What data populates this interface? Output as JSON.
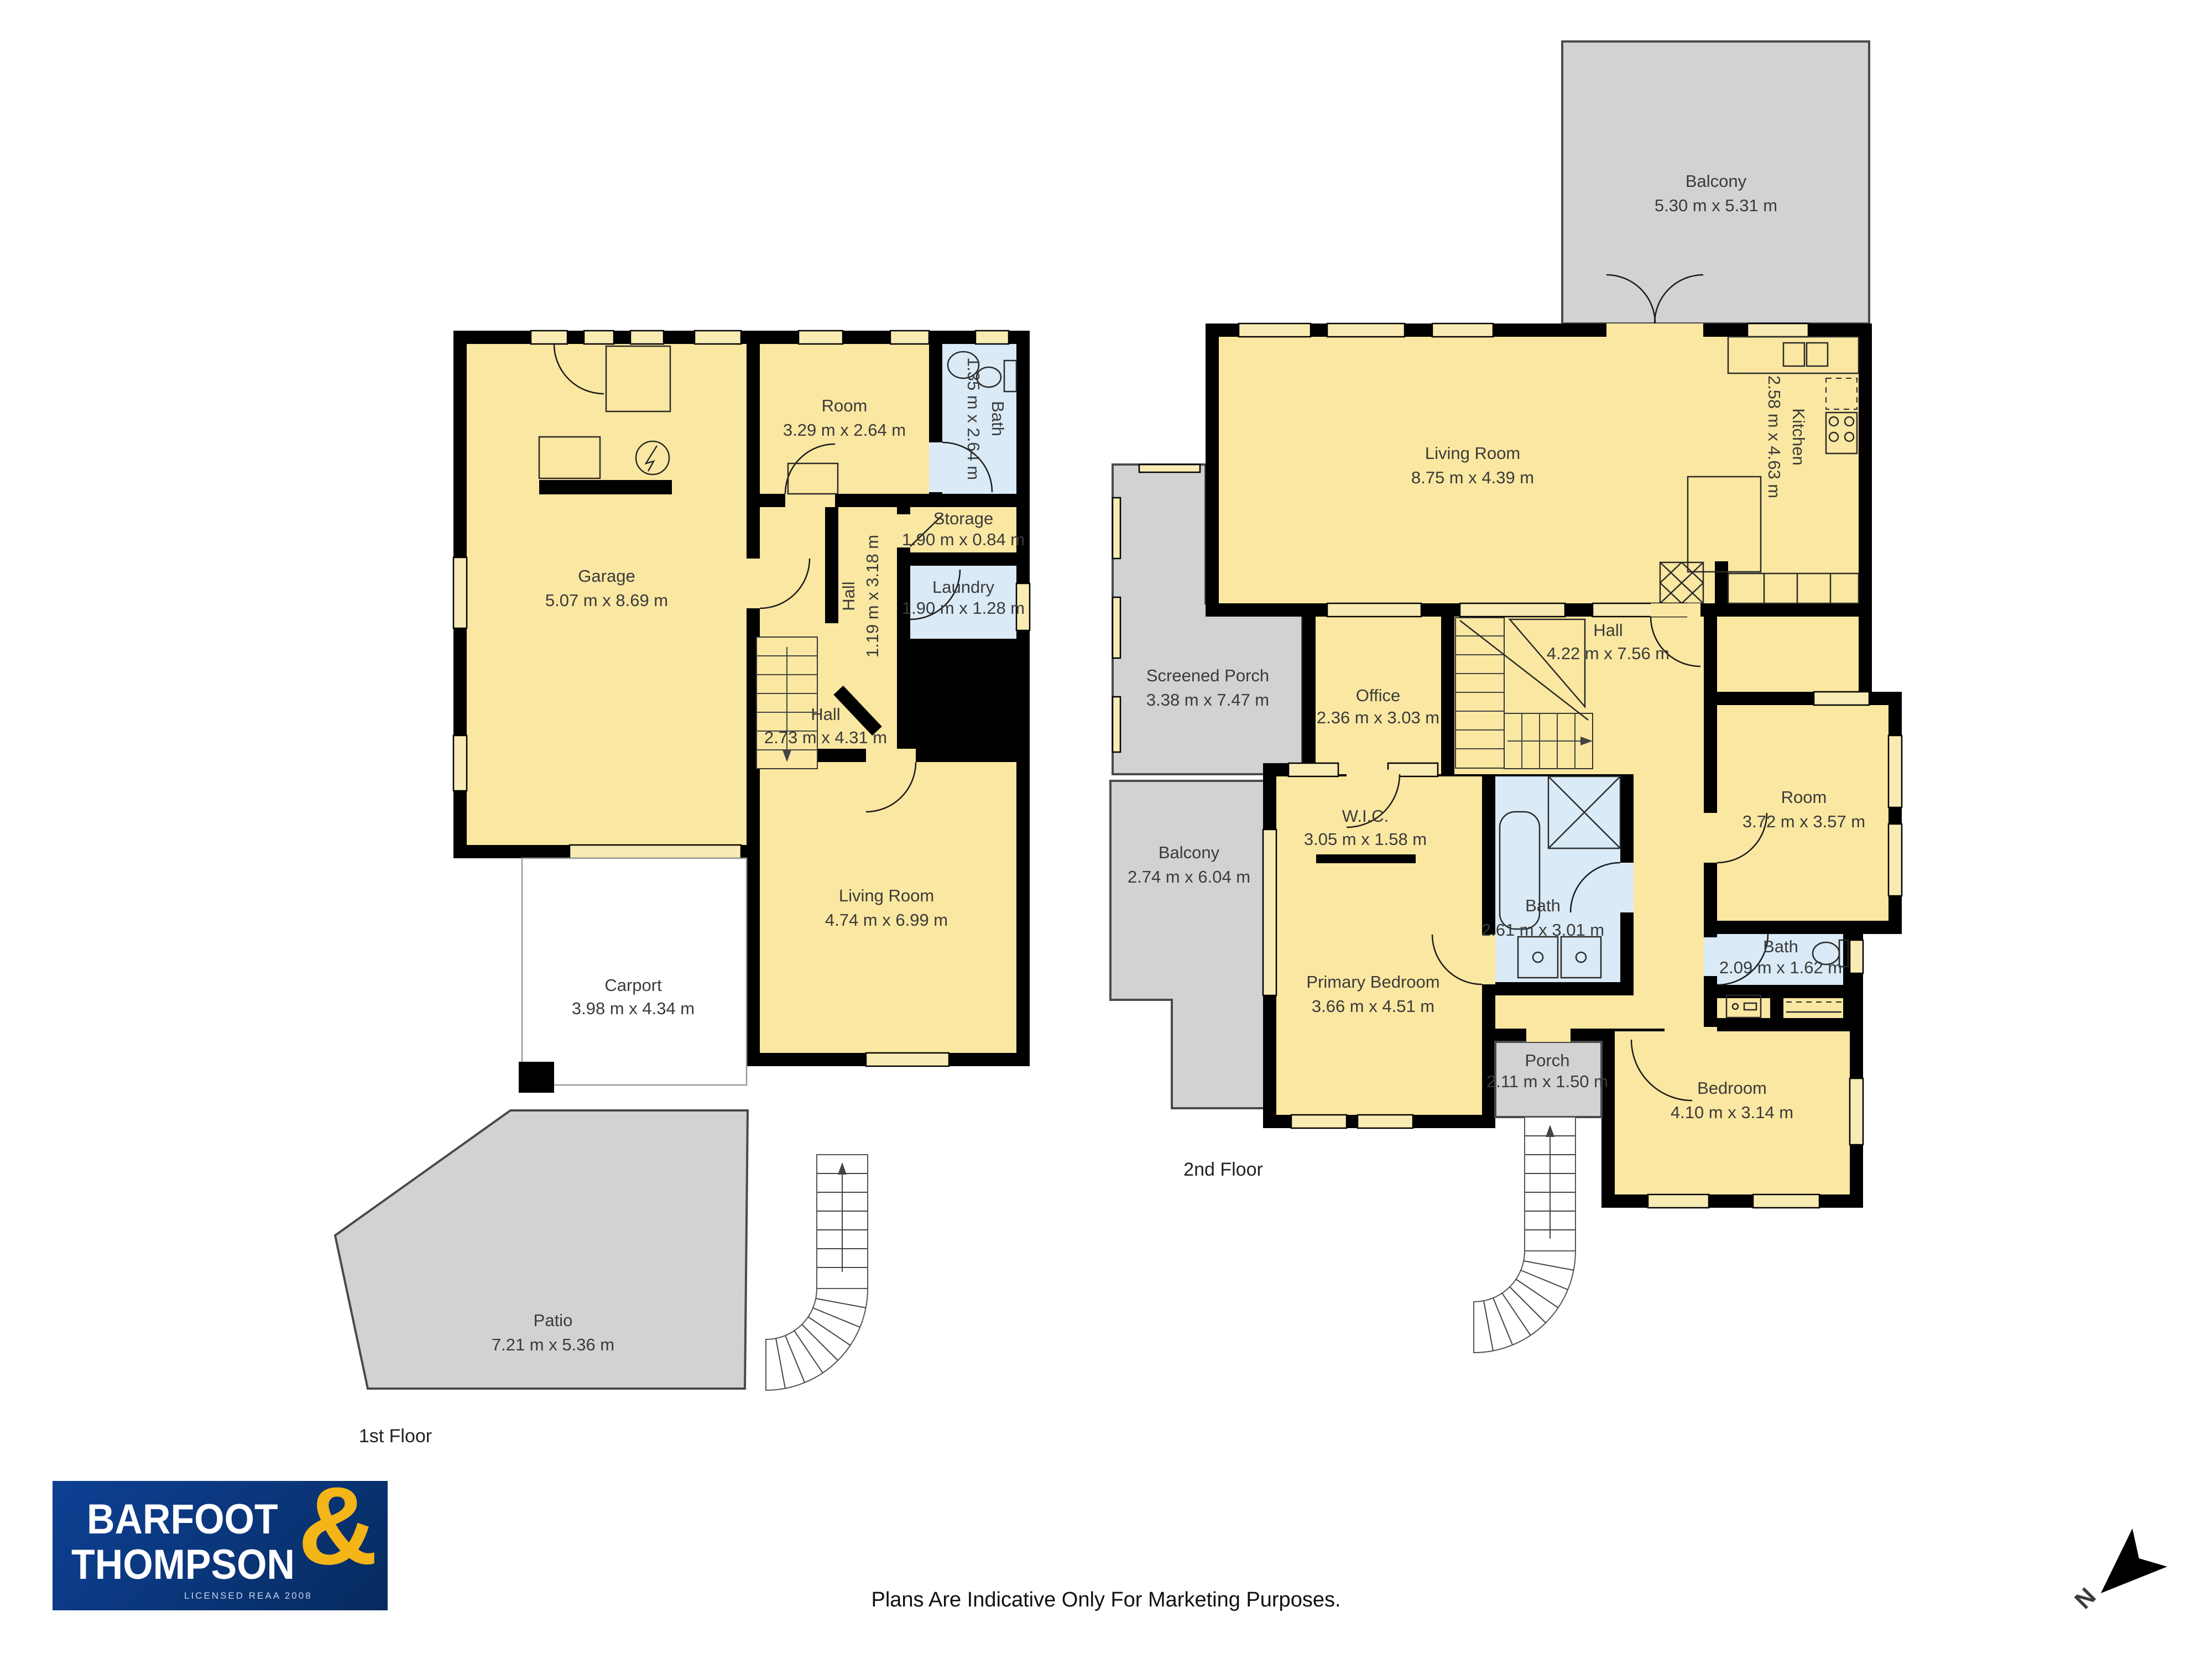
{
  "colors": {
    "room_fill": "#FAE7A1",
    "wet_fill": "#DAEAF6",
    "outdoor_fill": "#D2D2D2",
    "wall": "#000000",
    "logo_bg": "#0B3B87",
    "logo_accent": "#F3B517"
  },
  "floors": [
    {
      "label": "1st Floor",
      "rooms": [
        {
          "name": "Garage",
          "dims": "5.07 m x 8.69 m"
        },
        {
          "name": "Room",
          "dims": "3.29 m x 2.64 m"
        },
        {
          "name": "Bath",
          "dims": "1.35 m x 2.64 m"
        },
        {
          "name": "Storage",
          "dims": "1.90 m x 0.84 m"
        },
        {
          "name": "Hall",
          "dims": "1.19 m x 3.18 m"
        },
        {
          "name": "Laundry",
          "dims": "1.90 m x 1.28 m"
        },
        {
          "name": "Hall",
          "dims": "2.73 m x 4.31 m"
        },
        {
          "name": "Living Room",
          "dims": "4.74 m x 6.99 m"
        },
        {
          "name": "Carport",
          "dims": "3.98 m x 4.34 m"
        },
        {
          "name": "Patio",
          "dims": "7.21 m x 5.36 m"
        }
      ]
    },
    {
      "label": "2nd Floor",
      "rooms": [
        {
          "name": "Balcony",
          "dims": "5.30 m x 5.31 m"
        },
        {
          "name": "Living Room",
          "dims": "8.75 m x 4.39 m"
        },
        {
          "name": "Kitchen",
          "dims": "2.58 m x 4.63 m"
        },
        {
          "name": "Screened Porch",
          "dims": "3.38 m x 7.47 m"
        },
        {
          "name": "Office",
          "dims": "2.36 m x 3.03 m"
        },
        {
          "name": "Hall",
          "dims": "4.22 m x 7.56 m"
        },
        {
          "name": "Balcony",
          "dims": "2.74 m x 6.04 m"
        },
        {
          "name": "W.I.C.",
          "dims": "3.05 m x 1.58 m"
        },
        {
          "name": "Bath",
          "dims": "2.61 m x 3.01 m"
        },
        {
          "name": "Room",
          "dims": "3.72 m x 3.57 m"
        },
        {
          "name": "Primary Bedroom",
          "dims": "3.66 m x 4.51 m"
        },
        {
          "name": "Bath",
          "dims": "2.09 m x 1.62 m"
        },
        {
          "name": "Porch",
          "dims": "2.11 m x 1.50 m"
        },
        {
          "name": "Bedroom",
          "dims": "4.10 m x 3.14 m"
        }
      ]
    }
  ],
  "footer": {
    "disclaimer": "Plans Are Indicative Only For Marketing Purposes."
  },
  "logo": {
    "line1": "BARFOOT",
    "line2": "THOMPSON",
    "ampersand": "&",
    "license": "LICENSED REAA 2008"
  },
  "compass": {
    "label": "N"
  }
}
